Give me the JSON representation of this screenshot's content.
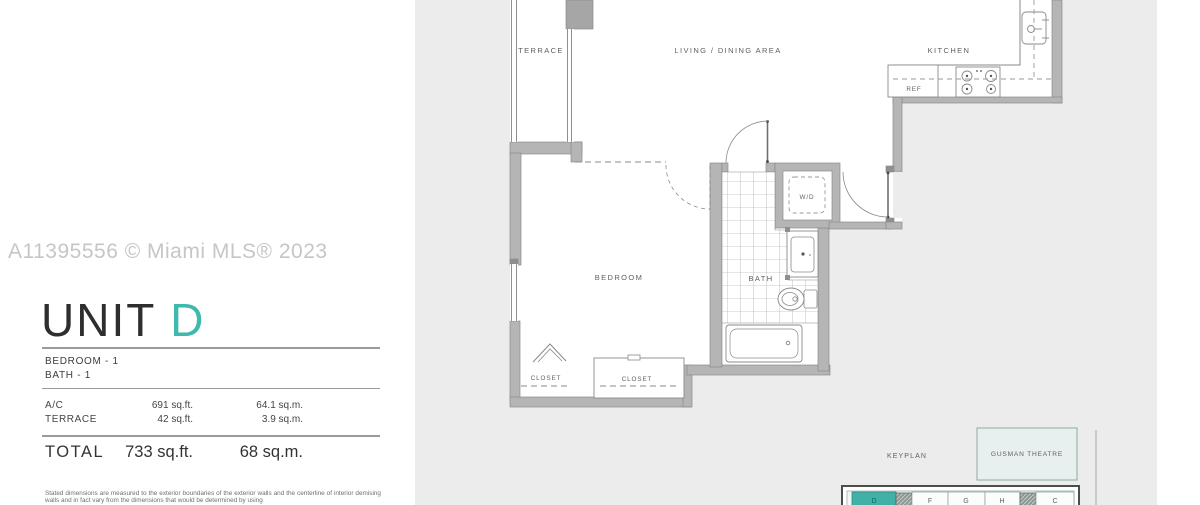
{
  "watermark": "A11395556 © Miami MLS® 2023",
  "accent_color": "#3eb9ad",
  "unit": {
    "title_prefix": "UNIT ",
    "title_letter": "D",
    "bedroom_line": "BEDROOM - 1",
    "bath_line": "BATH - 1"
  },
  "area_table": {
    "rows": [
      {
        "label": "A/C",
        "sqft": "691 sq.ft.",
        "sqm": "64.1 sq.m."
      },
      {
        "label": "TERRACE",
        "sqft": "42 sq.ft.",
        "sqm": "3.9 sq.m."
      }
    ],
    "total": {
      "label": "TOTAL",
      "sqft": "733 sq.ft.",
      "sqm": "68 sq.m."
    }
  },
  "disclaimer": "Stated dimensions are measured to the exterior boundaries of the exterior walls and the centerline of interior demising walls and in fact vary from the dimensions that would be determined by using",
  "plan": {
    "labels": {
      "terrace": "TERRACE",
      "living": "LIVING / DINING AREA",
      "kitchen": "KITCHEN",
      "ref": "REF",
      "wd": "W/D",
      "bedroom": "BEDROOM",
      "bath": "BATH",
      "closet1": "CLOSET",
      "closet2": "CLOSET"
    },
    "colors": {
      "outside_bg": "#ececec",
      "wall": "#b5b5b5",
      "line": "#8a8a8a",
      "keyplan_unit_fill": "#41b1a8"
    },
    "keyplan": {
      "label": "KEYPLAN",
      "theatre_label": "GUSMAN THEATRE",
      "highlighted_unit": "D",
      "units": [
        "D",
        "F",
        "G",
        "H",
        "C"
      ]
    }
  }
}
